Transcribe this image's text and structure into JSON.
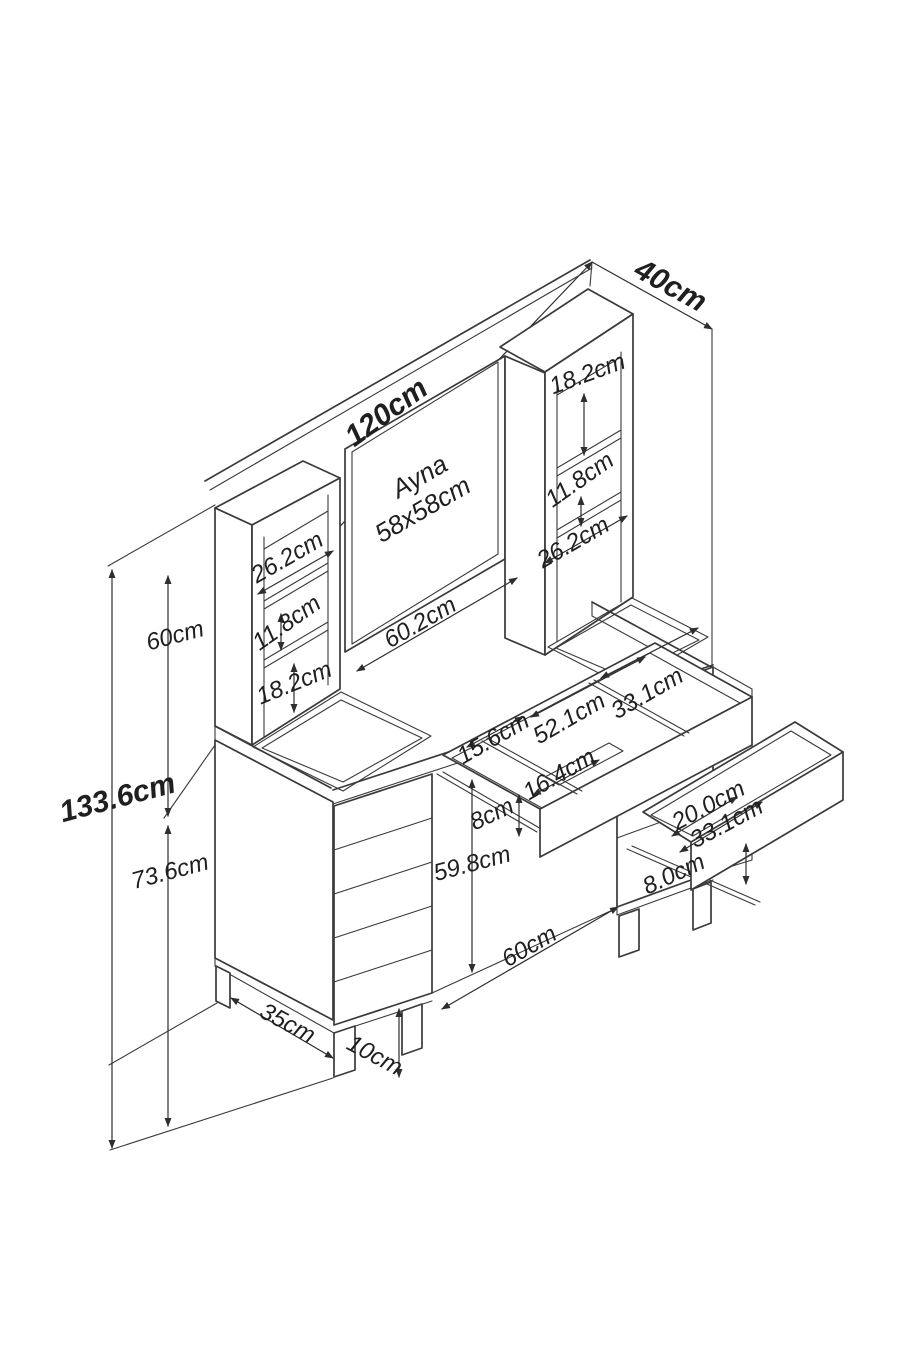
{
  "diagram": {
    "type": "furniture-dimension-diagram",
    "product": "dressing table (vanity) with mirror, shelf towers and drawers",
    "units": "cm",
    "colors": {
      "line": "#3a3a3a",
      "background": "#ffffff",
      "text": "#1f1f1f"
    },
    "labels": {
      "total_width": "120cm",
      "total_depth": "40cm",
      "total_height": "133.6cm",
      "upper_section_height": "60cm",
      "lower_section_height": "73.6cm",
      "mirror_name": "Ayna",
      "mirror_size": "58x58cm",
      "right_tower_top_opening": "18.2cm",
      "right_tower_middle_opening": "11.8cm",
      "right_desk_opening": "26.2cm",
      "left_tower_opening_width": "26.2cm",
      "left_tower_middle_opening": "11.8cm",
      "left_tower_bottom_opening": "18.2cm",
      "desk_opening_width": "60.2cm",
      "middle_drawer_left_compartment": "15.6cm",
      "middle_drawer_center_compartment": "52.1cm",
      "middle_drawer_right_compartment": "33.1cm",
      "middle_drawer_front_compartment": "16.4cm",
      "middle_drawer_height": "8cm",
      "knee_space_height": "59.8cm",
      "knee_space_width": "60cm",
      "pedestal_depth": "35cm",
      "leg_height": "10cm",
      "right_drawer_depth": "20.0cm",
      "right_drawer_width": "33.1cm",
      "right_drawer_height": "8.0cm"
    }
  }
}
